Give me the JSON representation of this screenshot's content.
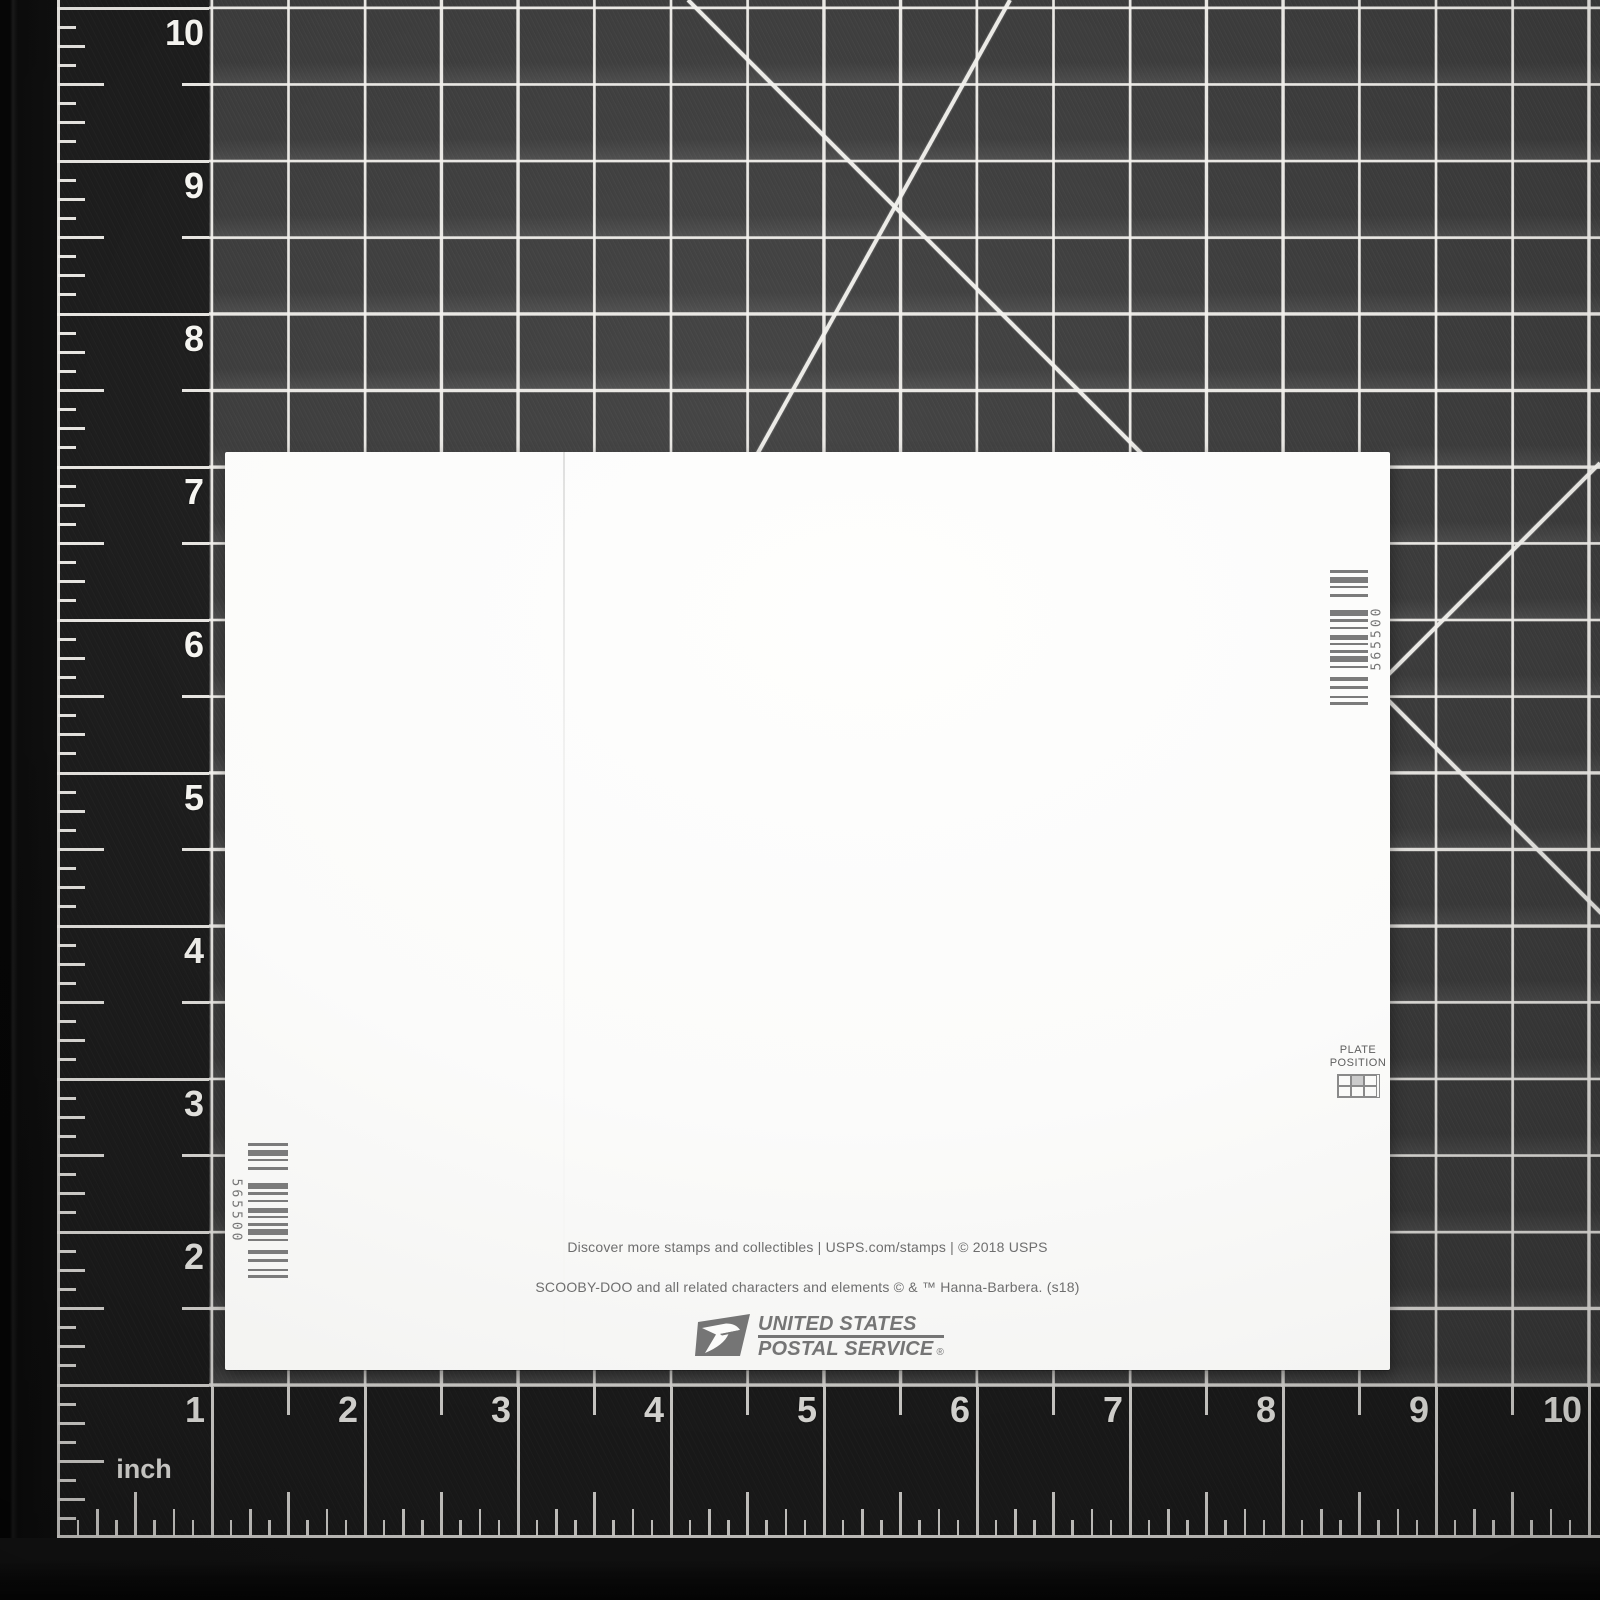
{
  "scene": {
    "description": "Back of a USPS Scooby-Doo stamp sheet lying on a black self-healing cutting mat with white inch grid"
  },
  "mat": {
    "unit_label": "inch",
    "left_ruler_numbers": [
      "10",
      "9",
      "8",
      "7",
      "6",
      "5",
      "4",
      "3",
      "2"
    ],
    "bottom_ruler_numbers": [
      "1",
      "2",
      "3",
      "4",
      "5",
      "6",
      "7",
      "8",
      "9",
      "10"
    ],
    "colors": {
      "surface": "#3c3c3c",
      "margin": "#1d1d1d",
      "grid_line": "#f2f0ec"
    }
  },
  "paper": {
    "barcode_number": "565500",
    "barcode_bars": [
      3,
      4,
      6,
      3,
      2,
      6,
      3,
      13,
      6,
      3,
      3,
      5,
      2,
      6,
      5,
      3,
      2,
      5,
      3,
      3,
      6,
      4,
      2,
      9,
      4,
      5,
      3,
      7,
      2,
      4,
      3
    ],
    "plate_position_line1": "PLATE",
    "plate_position_line2": "POSITION",
    "footer_line1": "Discover more stamps and collectibles  |  USPS.com/stamps  |  © 2018 USPS",
    "footer_line2": "SCOOBY-DOO and all related characters and elements © & ™ Hanna-Barbera. (s18)",
    "logo_line1": "UNITED STATES",
    "logo_line2": "POSTAL SERVICE",
    "logo_registered": "®"
  }
}
